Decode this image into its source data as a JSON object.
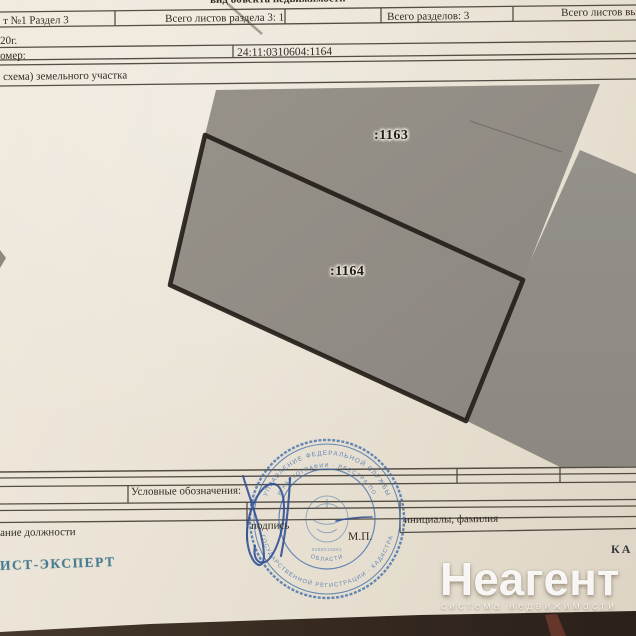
{
  "header": {
    "doc_type_title": "вид объекта недвижимости",
    "cells": [
      {
        "label": "т №1  Раздел 3"
      },
      {
        "label": "Всего листов раздела 3: 1"
      },
      {
        "label": "Всего разделов: 3"
      },
      {
        "label": "Всего листов вы"
      }
    ],
    "date_fragment": "20г.",
    "number_label_fragment": "омер:",
    "cadastral_number": "24:11:0310604:1164",
    "plan_caption_fragment": "схема) земельного участка"
  },
  "plan": {
    "parcels": [
      {
        "id": ":1163"
      },
      {
        "id": ":1164"
      }
    ]
  },
  "legend": {
    "label": "Условные обозначения:"
  },
  "signing": {
    "position_fragment": "ание должности",
    "sign_label": "подпись",
    "stamp_place": "М.П.",
    "name_label": "инициалы, фамилия"
  },
  "stamp": {
    "arc_top": "УПРАВЛЕНИЕ ФЕДЕРАЛЬНОЙ СЛУЖБЫ",
    "arc_mid": "И КАРТОГРАФИИ · РЕЕСТРА ПО",
    "arc_bottom": "ГОСУДАРСТВЕННОЙ РЕГИСТРАЦИИ · КАДАСТРА",
    "arc_inner": "ОБЛАСТИ",
    "tiny_number": "0489010661"
  },
  "footer": {
    "expert_fragment": "ИСТ-ЭКСПЕРТ",
    "edge_fragment": "КА"
  },
  "watermark": {
    "brand": "Неагент",
    "tagline": "система недвижимости"
  },
  "colors": {
    "paper": "#eae3d6",
    "parcel_gray": "#918c85",
    "outline_black": "#241e18",
    "stamp_blue": "#3e6dab",
    "signature_blue": "#2d4f96",
    "expert_blue": "#2e6b84",
    "table_dark": "#3b2f26",
    "watermark_white": "#ffffff"
  }
}
